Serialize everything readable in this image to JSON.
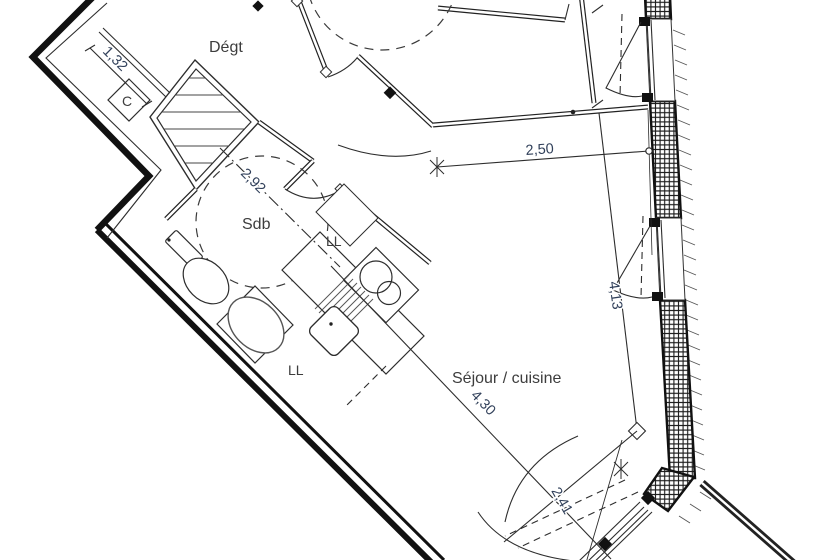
{
  "drawing": {
    "type": "apartment floor plan",
    "rooms": {
      "degt": "Dégt",
      "sdb": "Sdb",
      "sejour": "Séjour / cuisine",
      "closet": "C",
      "ll_top": "LL",
      "ll_bottom": "LL"
    },
    "dimensions": {
      "d132": "1,32",
      "d292": "2,92",
      "d250": "2,50",
      "d413": "4,13",
      "d430": "4,30",
      "d241": "2,41"
    },
    "colors": {
      "background": "#ffffff",
      "wall": "#111111",
      "line": "#2d2d2d",
      "dim_text": "#31405a",
      "label_text": "#3d3d3d"
    }
  }
}
